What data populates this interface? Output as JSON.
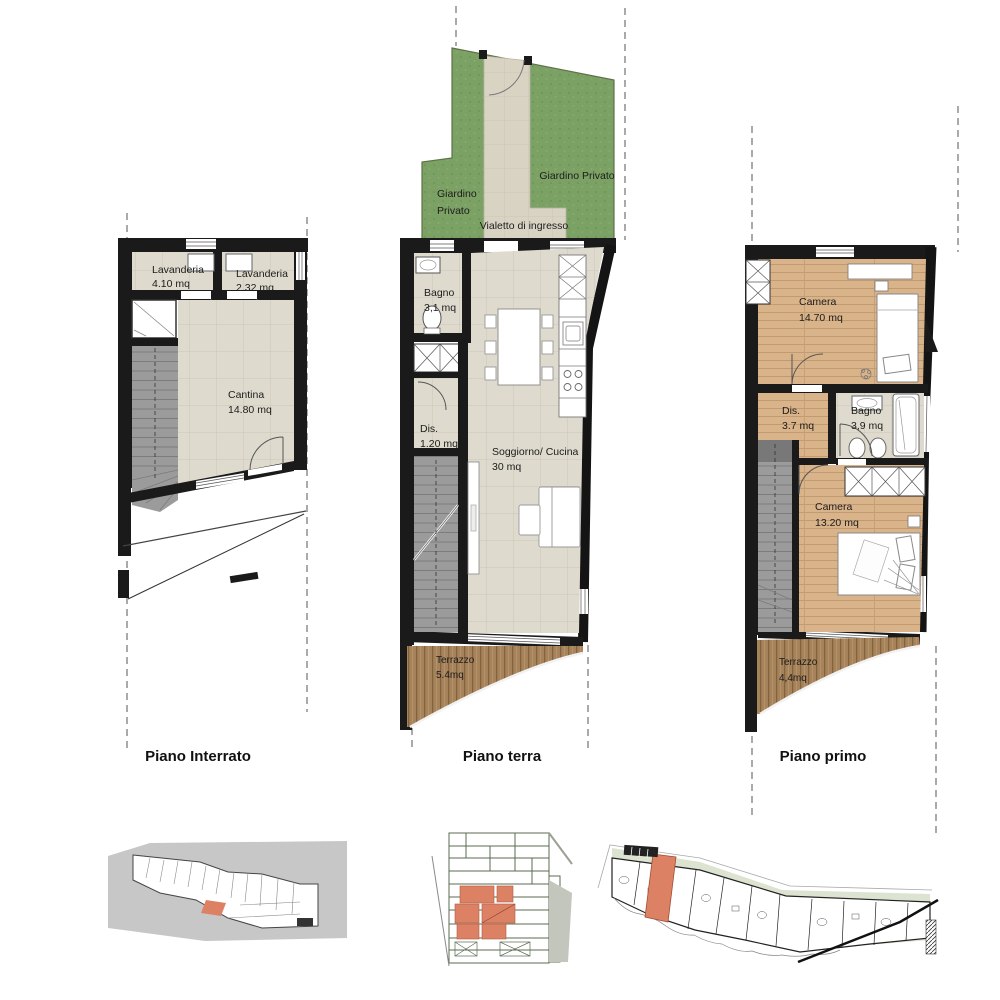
{
  "sheet": {
    "type": "architectural floor plans",
    "units_suffix": "mq"
  },
  "floors": {
    "interrato": {
      "title": "Piano Interrato",
      "rooms": {
        "lavanderia1": {
          "name": "Lavanderia",
          "area": "4.10 mq"
        },
        "lavanderia2": {
          "name": "Lavanderia",
          "area": "2.32 mq"
        },
        "cantina": {
          "name": "Cantina",
          "area": "14.80 mq"
        }
      }
    },
    "terra": {
      "title": "Piano terra",
      "outdoor": {
        "giardino_left_line1": "Giardino",
        "giardino_left_line2": "Privato",
        "giardino_right": "Giardino Privato",
        "vialetto": "Vialetto di ingresso"
      },
      "rooms": {
        "bagno": {
          "name": "Bagno",
          "area": "3,1 mq"
        },
        "dis": {
          "name": "Dis.",
          "area": "1.20 mq"
        },
        "soggiorno": {
          "name": "Soggiorno/ Cucina",
          "area": "30 mq"
        },
        "terrazzo": {
          "name": "Terrazzo",
          "area": "5.4mq"
        }
      }
    },
    "primo": {
      "title": "Piano primo",
      "rooms": {
        "camera1": {
          "name": "Camera",
          "area": "14.70 mq"
        },
        "dis": {
          "name": "Dis.",
          "area": "3.7 mq"
        },
        "bagno": {
          "name": "Bagno",
          "area": "3,9 mq"
        },
        "camera2": {
          "name": "Camera",
          "area": "13.20 mq"
        },
        "terrazzo": {
          "name": "Terrazzo",
          "area": "4,4mq"
        }
      }
    }
  },
  "colors": {
    "wall": "#1a1a1a",
    "tile_floor": "#dedacd",
    "wood_deck": "#a7835b",
    "wood_floor": "#d9b38a",
    "stairs": "#9b9b9b",
    "garden_green": "#7ca165",
    "path_beige": "#d9d3c4",
    "highlight_unit_orange": "#dd8165",
    "key_plan_gray": "#c7c7c7",
    "key_plan_pale_green": "#dce3d0"
  }
}
